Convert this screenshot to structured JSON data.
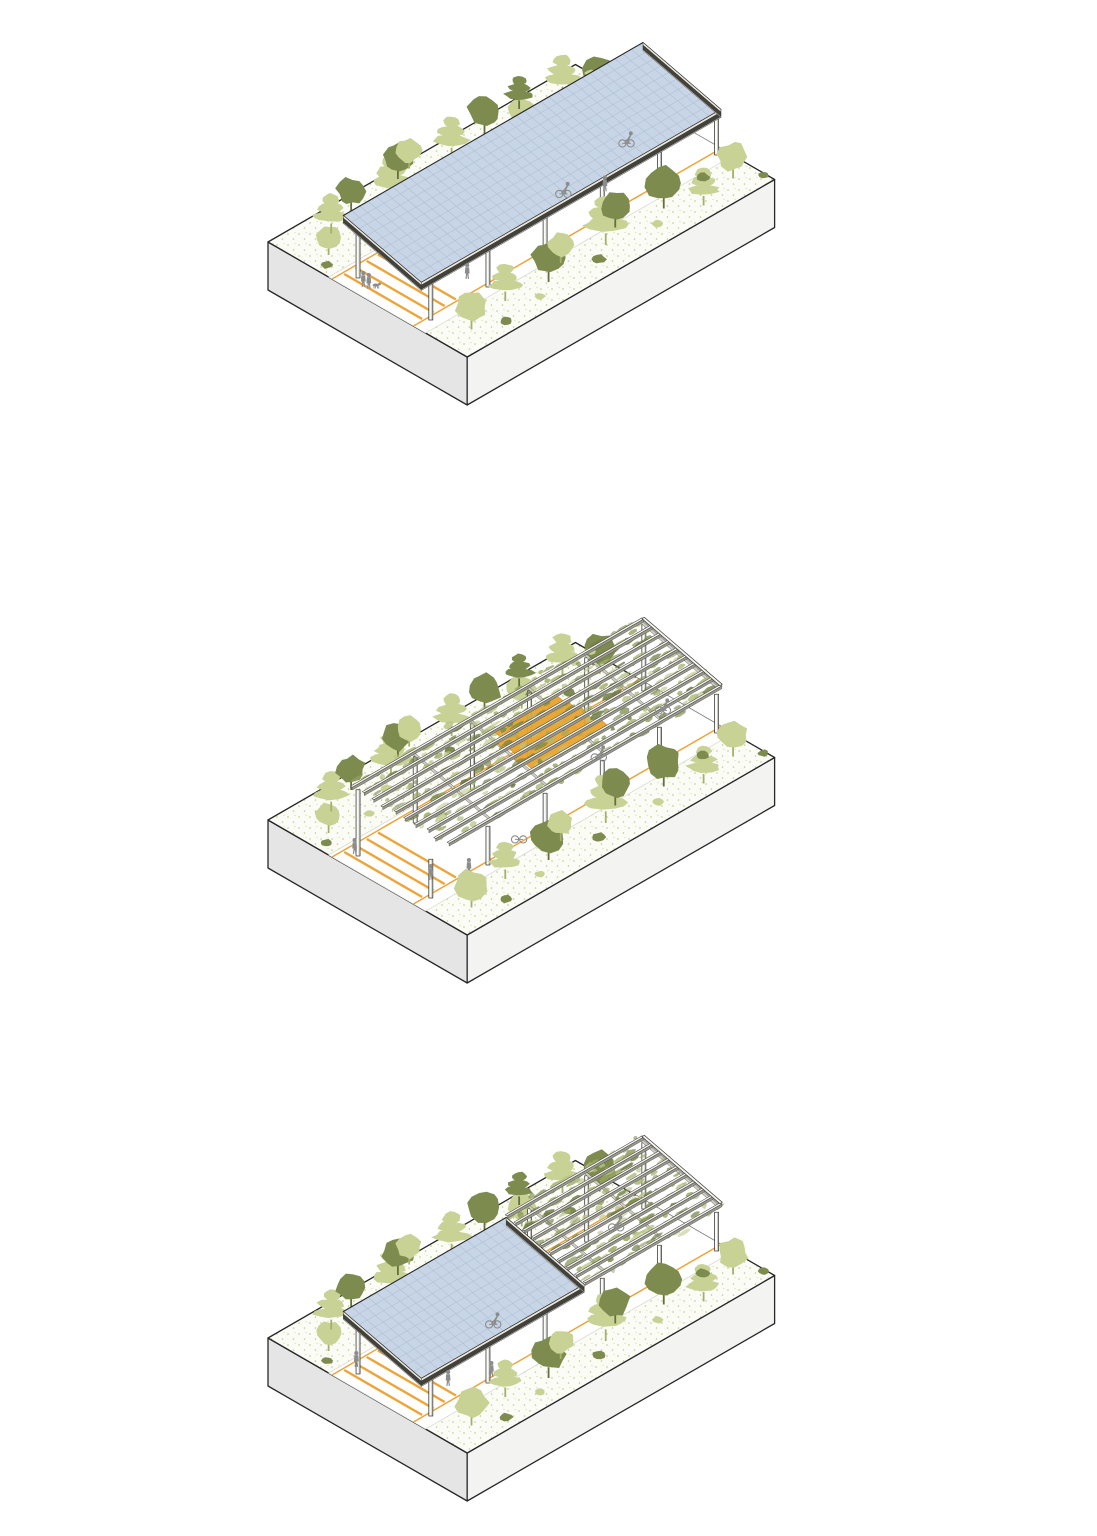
{
  "page": {
    "background": "#ffffff"
  },
  "colors": {
    "slab_top": "#fcfcf7",
    "slab_left": "#e4e5e4",
    "slab_front": "#f3f3f1",
    "outline": "#282828",
    "path_fill": "#ffffff",
    "path_edge": "#d3d3cb",
    "orange_line": "#eda438",
    "awning": "#e9a42c",
    "awning_edge": "#bd8316",
    "solar_fill": "#c7d5e6",
    "solar_grid": "#afc0d5",
    "fascia_light": "#e9e7dc",
    "fascia_dark": "#42413b",
    "column_fill": "#fbfbf9",
    "column_stroke": "#3e3e3a",
    "column_shade": "#b9b9b3",
    "rail_top": "#f5f5f2",
    "rail_side": "#98988f",
    "rail_stroke": "#45443e",
    "crossbeam": "#cfcfc8",
    "veg_greens": [
      "#b9c584",
      "#99a75f",
      "#7d8c4c",
      "#6f7d45",
      "#aab873"
    ],
    "tree_light": "#c8d295",
    "tree_light_trunk": "#a6b06d",
    "tree_dark": "#7d8c4e",
    "tree_dark_trunk": "#62703c",
    "figure": "#8c8c8c",
    "speckle_a": "#c9d3a0",
    "speckle_b": "#bdc892",
    "speckle_c": "#d3dcb0"
  },
  "iso": {
    "ax": 0.866,
    "slab_length": 355,
    "slab_width": 230,
    "slab_thickness": 48
  },
  "scene": {
    "path": {
      "v0": 70,
      "v1": 182,
      "line_a_v": 74,
      "line_b_v": 168,
      "stripes_u": [
        12,
        25,
        38,
        51
      ]
    },
    "roof": {
      "v0": 85,
      "v1": 175,
      "z_back": 68,
      "z_front": 46,
      "fascia_depth": 8
    },
    "column_rows": [
      {
        "v": 88
      },
      {
        "v": 172
      }
    ],
    "column_u": [
      16,
      82,
      148,
      214,
      280,
      346
    ],
    "rail_count": 10,
    "trees": [
      {
        "u": 22,
        "v": 48,
        "s": 30,
        "tone": "light",
        "kind": "round"
      },
      {
        "u": 8,
        "v": 60,
        "s": 10,
        "tone": "dark",
        "kind": "bush"
      },
      {
        "u": 45,
        "v": 28,
        "s": 36,
        "tone": "light",
        "kind": "tiered"
      },
      {
        "u": 62,
        "v": 55,
        "s": 9,
        "tone": "light",
        "kind": "bush"
      },
      {
        "u": 78,
        "v": 18,
        "s": 34,
        "tone": "dark",
        "kind": "round"
      },
      {
        "u": 96,
        "v": 42,
        "s": 12,
        "tone": "light",
        "kind": "bush"
      },
      {
        "u": 112,
        "v": 30,
        "s": 42,
        "tone": "light",
        "kind": "tiered"
      },
      {
        "u": 138,
        "v": 12,
        "s": 36,
        "tone": "dark",
        "kind": "round"
      },
      {
        "u": 155,
        "v": 8,
        "s": 30,
        "tone": "light",
        "kind": "round"
      },
      {
        "u": 172,
        "v": 38,
        "s": 10,
        "tone": "dark",
        "kind": "bush"
      },
      {
        "u": 190,
        "v": 22,
        "s": 38,
        "tone": "light",
        "kind": "tiered"
      },
      {
        "u": 215,
        "v": 45,
        "s": 13,
        "tone": "light",
        "kind": "bush"
      },
      {
        "u": 232,
        "v": 18,
        "s": 40,
        "tone": "dark",
        "kind": "round"
      },
      {
        "u": 258,
        "v": 35,
        "s": 34,
        "tone": "light",
        "kind": "round"
      },
      {
        "u": 278,
        "v": 12,
        "s": 30,
        "tone": "dark",
        "kind": "tiered"
      },
      {
        "u": 298,
        "v": 50,
        "s": 11,
        "tone": "dark",
        "kind": "bush"
      },
      {
        "u": 315,
        "v": 25,
        "s": 38,
        "tone": "light",
        "kind": "tiered"
      },
      {
        "u": 338,
        "v": 45,
        "s": 40,
        "tone": "dark",
        "kind": "round"
      },
      {
        "u": 352,
        "v": 20,
        "s": 9,
        "tone": "light",
        "kind": "bush"
      },
      {
        "u": 30,
        "v": 205,
        "s": 38,
        "tone": "light",
        "kind": "round"
      },
      {
        "u": 55,
        "v": 220,
        "s": 11,
        "tone": "dark",
        "kind": "bush"
      },
      {
        "u": 78,
        "v": 196,
        "s": 34,
        "tone": "light",
        "kind": "tiered"
      },
      {
        "u": 100,
        "v": 214,
        "s": 9,
        "tone": "light",
        "kind": "bush"
      },
      {
        "u": 122,
        "v": 202,
        "s": 40,
        "tone": "dark",
        "kind": "round"
      },
      {
        "u": 148,
        "v": 190,
        "s": 30,
        "tone": "light",
        "kind": "round"
      },
      {
        "u": 170,
        "v": 212,
        "s": 12,
        "tone": "dark",
        "kind": "bush"
      },
      {
        "u": 192,
        "v": 198,
        "s": 44,
        "tone": "light",
        "kind": "tiered"
      },
      {
        "u": 215,
        "v": 186,
        "s": 36,
        "tone": "dark",
        "kind": "round"
      },
      {
        "u": 240,
        "v": 210,
        "s": 10,
        "tone": "light",
        "kind": "bush"
      },
      {
        "u": 262,
        "v": 195,
        "s": 42,
        "tone": "dark",
        "kind": "round"
      },
      {
        "u": 288,
        "v": 215,
        "s": 34,
        "tone": "light",
        "kind": "tiered"
      },
      {
        "u": 312,
        "v": 190,
        "s": 12,
        "tone": "dark",
        "kind": "bush"
      },
      {
        "u": 332,
        "v": 205,
        "s": 36,
        "tone": "light",
        "kind": "round"
      },
      {
        "u": 350,
        "v": 222,
        "s": 9,
        "tone": "dark",
        "kind": "bush"
      }
    ]
  },
  "diagrams": [
    {
      "id": "solar-canopy",
      "origin": [
        268,
        242
      ],
      "seed": 11,
      "roof_segments": [
        {
          "type": "solar",
          "u0": 2,
          "u1": 348
        }
      ],
      "figures": [
        {
          "type": "pair-dog",
          "u": 10,
          "v": 100
        },
        {
          "type": "walker",
          "u": 78,
          "v": 152
        },
        {
          "type": "cyclist",
          "u": 215,
          "v": 126
        },
        {
          "type": "walker",
          "u": 245,
          "v": 144
        },
        {
          "type": "cyclist",
          "u": 302,
          "v": 112
        }
      ]
    },
    {
      "id": "green-pergola",
      "origin": [
        268,
        820
      ],
      "seed": 29,
      "roof_segments": [
        {
          "type": "green",
          "u0": 40,
          "u1": 348,
          "staggered_start": true,
          "awning": {
            "u0": 150,
            "u1": 238,
            "rows": [
              2,
              3,
              4,
              5,
              6
            ]
          }
        }
      ],
      "figures": [
        {
          "type": "walker",
          "u": 16,
          "v": 84
        },
        {
          "type": "walker",
          "u": 34,
          "v": 154
        },
        {
          "type": "walker",
          "u": 62,
          "v": 170
        },
        {
          "type": "parked-bike",
          "u": 122,
          "v": 168
        },
        {
          "type": "cyclist",
          "u": 250,
          "v": 132
        },
        {
          "type": "cyclist",
          "u": 334,
          "v": 122
        }
      ]
    },
    {
      "id": "hybrid-canopy",
      "origin": [
        268,
        1338
      ],
      "seed": 47,
      "roof_segments": [
        {
          "type": "green",
          "u0": 190,
          "u1": 348,
          "staggered_start": false
        },
        {
          "type": "solar",
          "u0": 2,
          "u1": 190
        }
      ],
      "figures": [
        {
          "type": "walker",
          "u": 22,
          "v": 80
        },
        {
          "type": "walker",
          "u": 56,
          "v": 152
        },
        {
          "type": "walker",
          "u": 90,
          "v": 168
        },
        {
          "type": "cyclist",
          "u": 140,
          "v": 120
        },
        {
          "type": "cyclist",
          "u": 308,
          "v": 94
        }
      ]
    }
  ]
}
